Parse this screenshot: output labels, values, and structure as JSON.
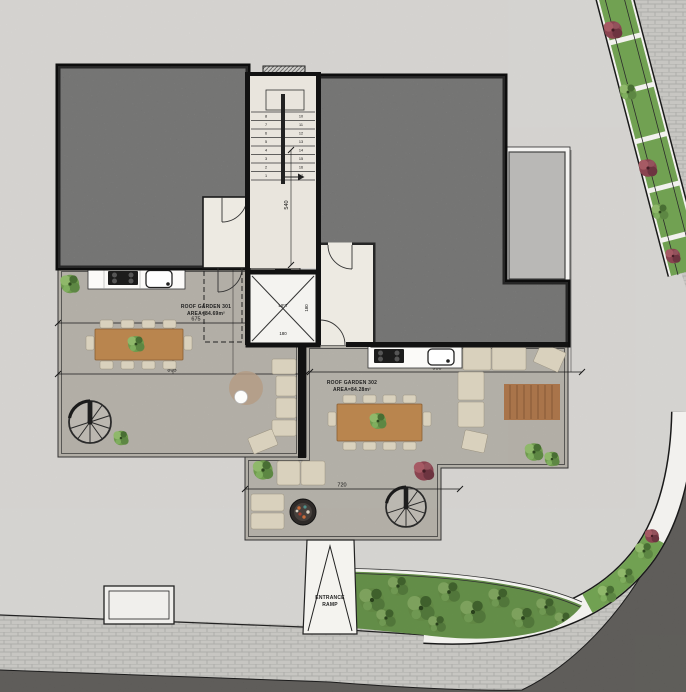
{
  "plan": {
    "areas": {
      "roof_garden_301": {
        "name": "ROOF GARDEN 301",
        "area": "AREA=84.69m²"
      },
      "roof_garden_302": {
        "name": "ROOF GARDEN 302",
        "area": "AREA=84.28m²"
      },
      "lift": {
        "name": "LIFT",
        "width": "180",
        "depth": "180"
      },
      "entrance_ramp": {
        "line1": "ENTRANCE",
        "line2": "RAMP"
      }
    },
    "dimensions": {
      "d675": "675",
      "d805": "805",
      "d300": "300",
      "d540": "540",
      "d950": "950",
      "d720": "720"
    },
    "stairs": {
      "left": [
        "8",
        "7",
        "6",
        "5",
        "4",
        "3",
        "2",
        "1"
      ],
      "right": [
        "10",
        "11",
        "12",
        "13",
        "14",
        "15",
        "16",
        "17"
      ]
    },
    "colors": {
      "concrete": "#e7e5e2",
      "asphalt": "#45433f",
      "roof_dark": "#8d8d8c",
      "roof_light": "#b9b8b6",
      "terrace_floor": "#c7c3ba",
      "hall_floor": "#e9e5dd",
      "white_room": "#edeae2",
      "wood": "#b9854e",
      "sofa": "#d9d1bd",
      "greenery": "#71a152",
      "bush_red": "#7e3b44",
      "rug_round": "#b49c85",
      "rug_rect": "#a9744a",
      "wall": "#121212"
    }
  }
}
